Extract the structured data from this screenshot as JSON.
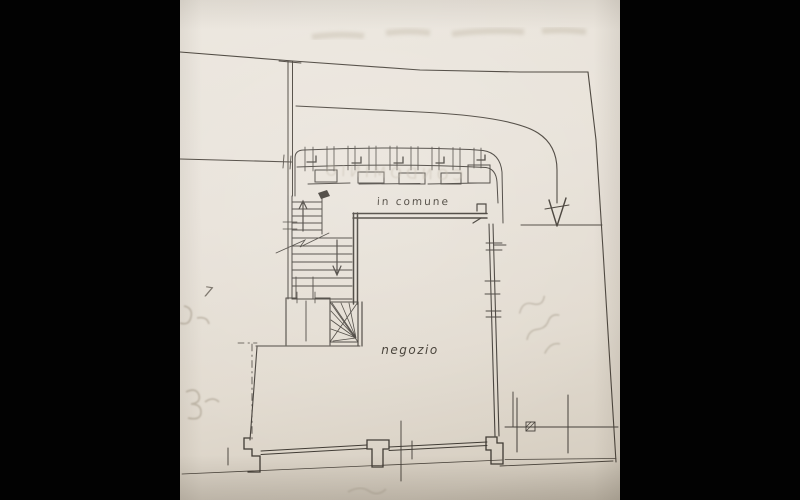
{
  "plan": {
    "labels": {
      "common_area": "in comune",
      "shop": "negozio",
      "handwritten_mark": "7"
    },
    "bleed_through_text": "CONDOMINIO",
    "colors": {
      "letterbox": "#000000",
      "paper": "#e7e1d8",
      "ink": "#46403a",
      "pencil": "#b3aa9c"
    }
  }
}
